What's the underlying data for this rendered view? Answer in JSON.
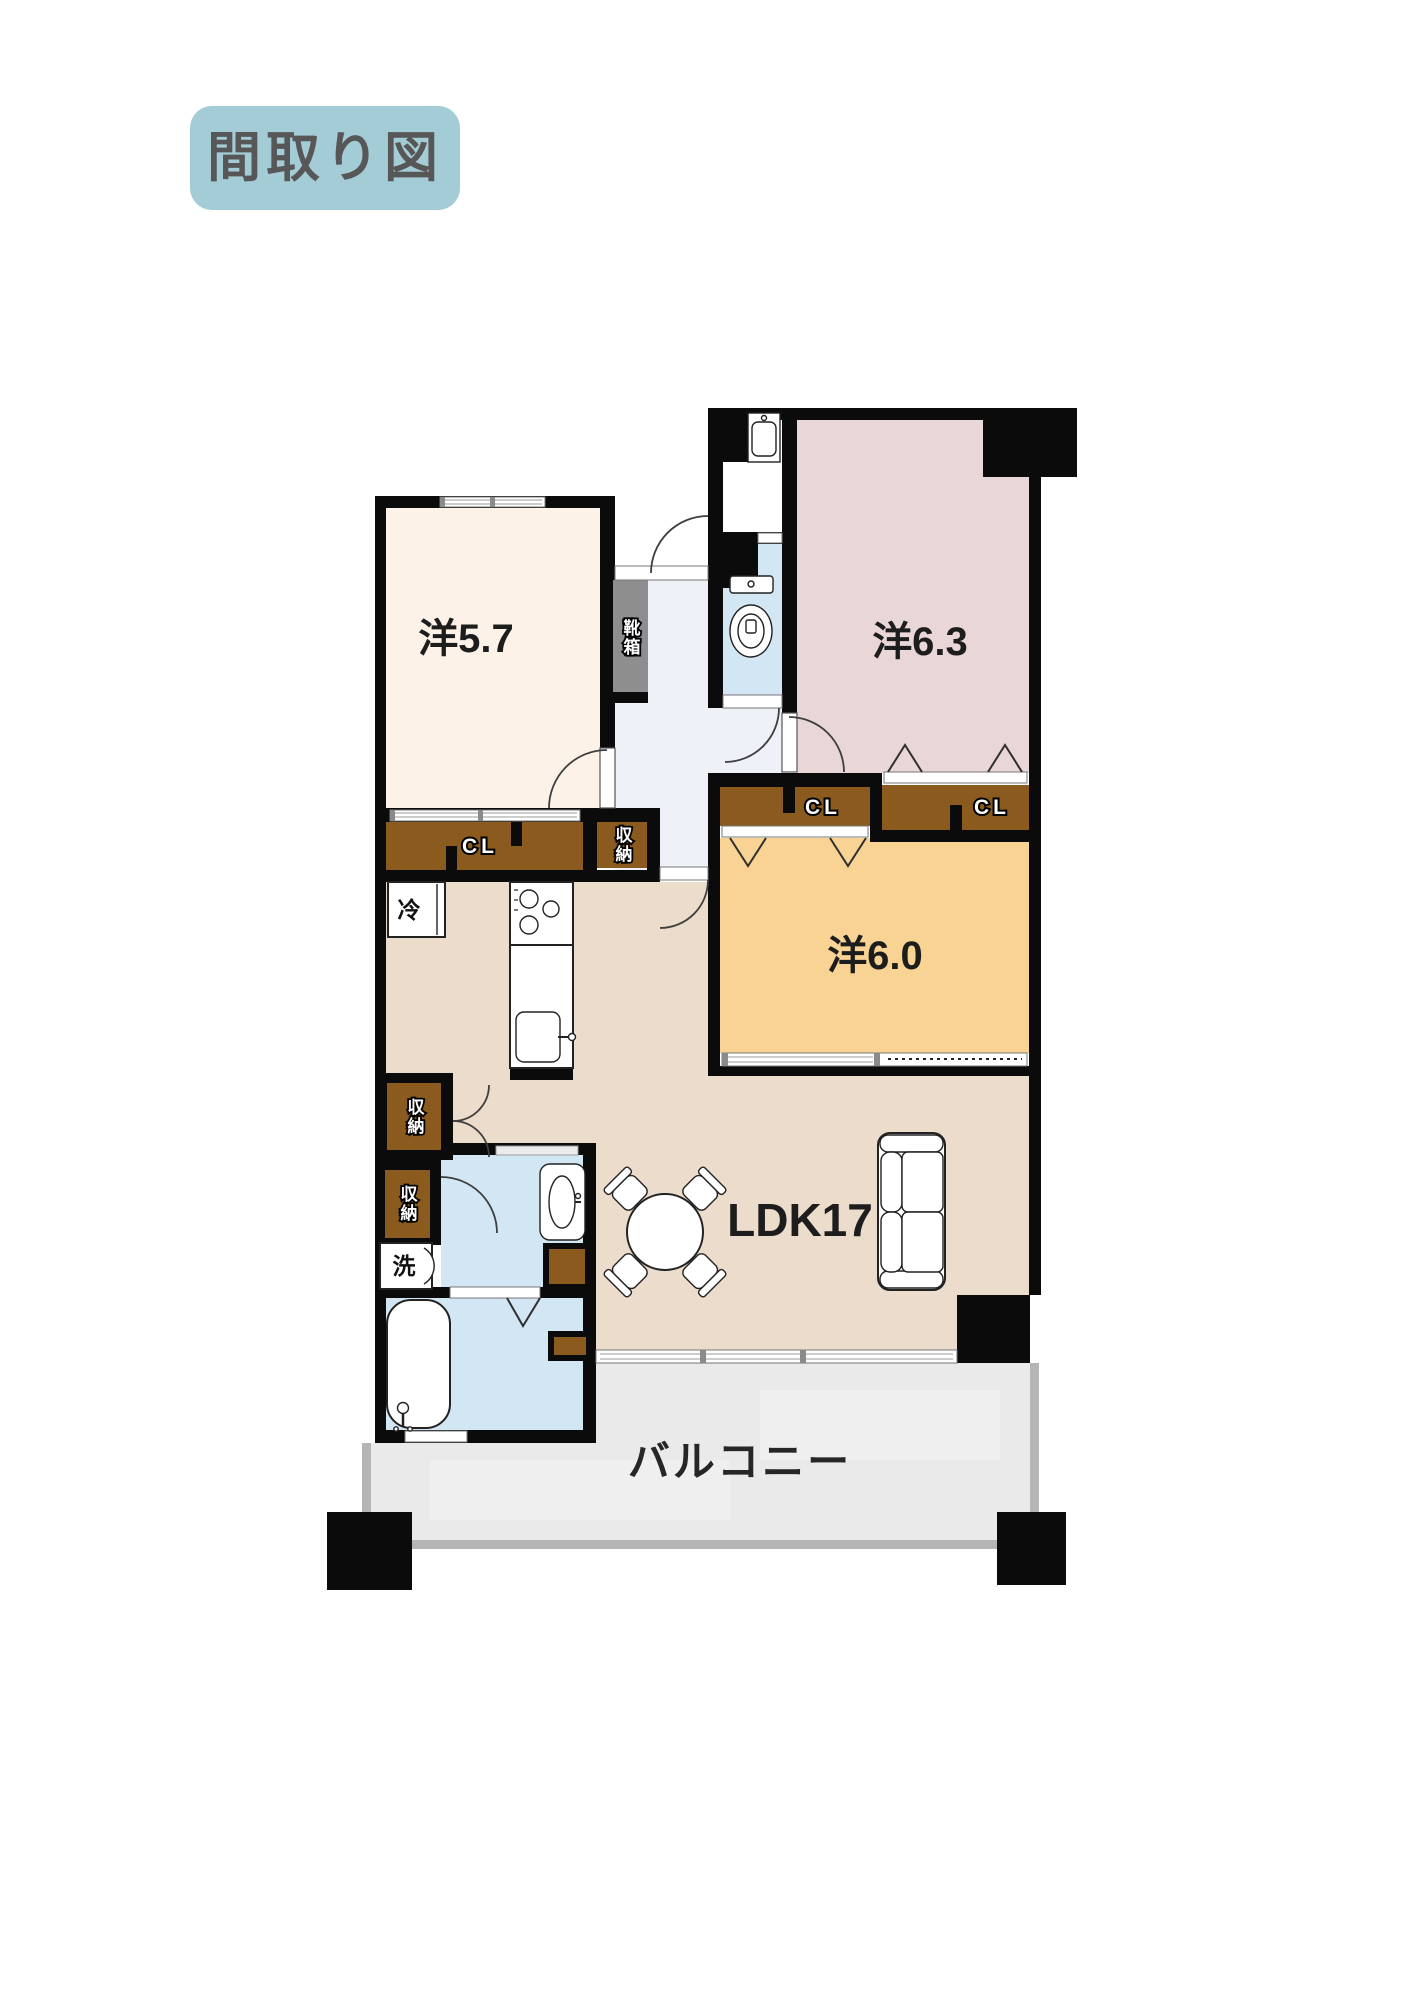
{
  "title_badge": {
    "label": "間取り図",
    "bg": "#a3ccd6",
    "text_color": "#575757"
  },
  "floorplan": {
    "wall_color": "#0b0b0b",
    "rooms": {
      "western_5_7": {
        "label": "洋5.7",
        "color": "#fcf2e8"
      },
      "western_6_3": {
        "label": "洋6.3",
        "color": "#e9d7d7"
      },
      "western_6_0": {
        "label": "洋6.0",
        "color": "#f8d393"
      },
      "ldk": {
        "label": "LDK17",
        "color": "#ebdccc"
      },
      "balcony": {
        "label": "バルコニー",
        "color": "#eaeaea",
        "border_color": "#b5b5b5"
      },
      "hallway": {
        "color": "#eef1f7"
      },
      "wet_area": {
        "color": "#d3e6f4"
      }
    },
    "storage": {
      "closet_label": "CL",
      "storage_label": "収納",
      "shoe_cabinet_label": "靴箱",
      "closet_color": "#8a5a1e",
      "shoe_cabinet_color": "#8e8e8e"
    },
    "appliances": {
      "refrigerator_label": "冷",
      "washer_label": "洗"
    },
    "fixtures": [
      "toilet-icon",
      "wash-basin-icon",
      "vanity-basin-icon",
      "bathtub-icon",
      "kitchen-sink-icon",
      "stove-icon",
      "refrigerator-icon",
      "washing-machine-icon",
      "dining-table-icon",
      "chair-icon",
      "sofa-icon",
      "door-swing-icon",
      "window-icon",
      "folding-door-icon",
      "pillar-icon"
    ]
  }
}
